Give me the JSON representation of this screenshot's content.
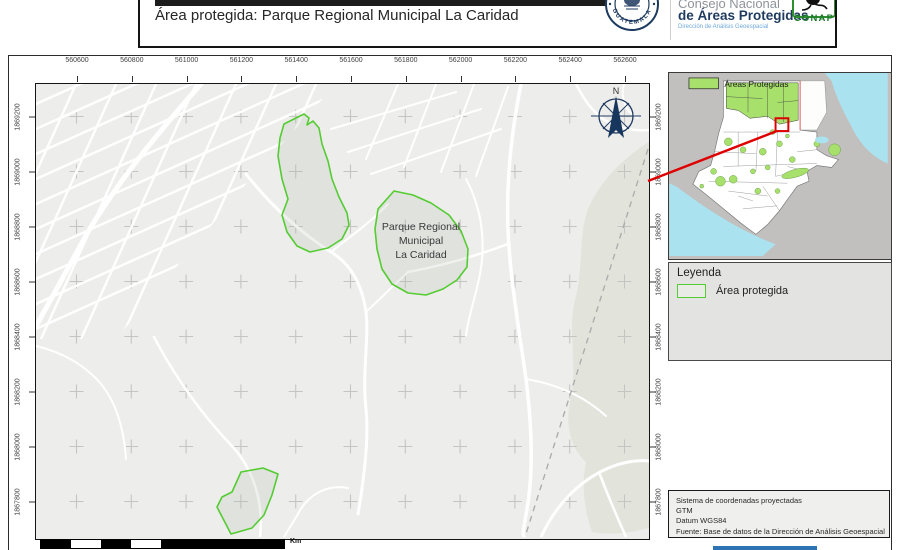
{
  "header": {
    "title": "Área protegida: Parque Regional Municipal La Caridad",
    "org_line1": "Consejo Nacional",
    "org_line2": "de Áreas Protegidas",
    "org_line3": "Dirección de Análisis Geoespacial",
    "seal_text": "GUATEMALA",
    "conap": "CONAP"
  },
  "axes": {
    "x_ticks": [
      "560600",
      "560800",
      "561000",
      "561200",
      "561400",
      "561600",
      "561800",
      "562000",
      "562200",
      "562400",
      "562600"
    ],
    "y_ticks": [
      "1869200",
      "1869000",
      "1868800",
      "1868600",
      "1868400",
      "1868200",
      "1868000",
      "1867800"
    ]
  },
  "map": {
    "area_label_lines": [
      "Parque Regional",
      "Municipal",
      "La Caridad"
    ],
    "north": "N",
    "scale_unit": "Km"
  },
  "overview": {
    "legend_label": "Áreas Protegidas"
  },
  "legend": {
    "title": "Leyenda",
    "item": "Área protegida"
  },
  "source": {
    "lines": [
      "Sistema de coordenadas proyectadas",
      "GTM",
      "Datum WGS84",
      "Fuente: Base de datos de la Dirección de Análisis Geoespacial"
    ]
  },
  "colors": {
    "protected_stroke": "#54cc32",
    "protected_fill": "#e9ebe7",
    "overview_green": "#a8e06c",
    "water": "#abe2f0",
    "accent_red": "#de0000",
    "navy": "#1e3a5f",
    "conap_green": "#2f8f2f"
  }
}
